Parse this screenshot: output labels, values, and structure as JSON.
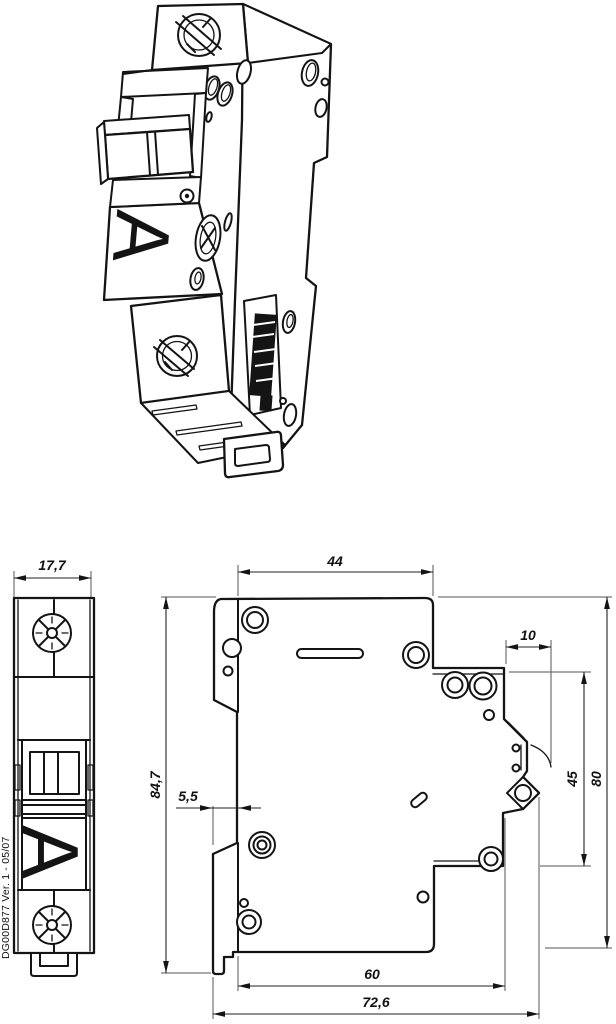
{
  "doc_reference": "DG00D877 Ver. 1 - 05/07",
  "marking_letter": "A",
  "views": {
    "isometric": {},
    "front": {
      "width": "17,7"
    },
    "side": {
      "top_depth": "44",
      "overall_height": "84,7",
      "front_step": "5,5",
      "rail_notch_width": "10",
      "rail_recess_height": "45",
      "mounting_height": "80",
      "rail_depth": "60",
      "overall_depth": "72,6"
    }
  },
  "colors": {
    "line": "#141414",
    "background": "#ffffff"
  }
}
